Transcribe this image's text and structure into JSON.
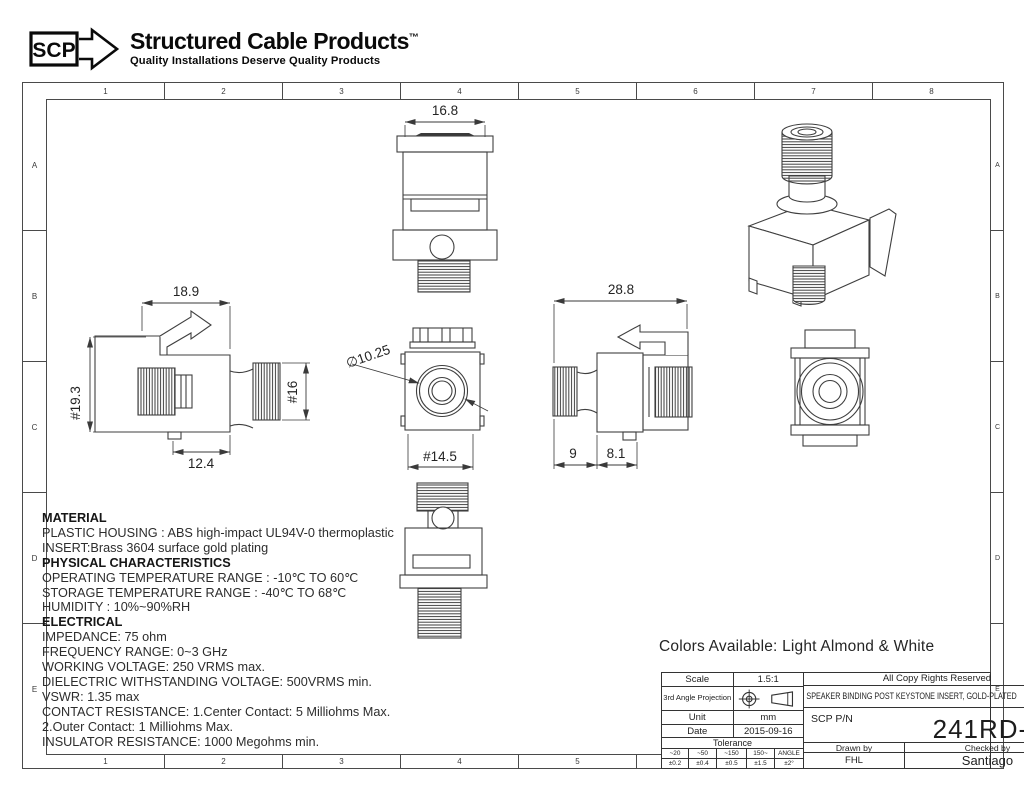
{
  "logo": {
    "abbr": "SCP",
    "name": "Structured Cable Products",
    "trademark": "™",
    "tagline": "Quality Installations Deserve Quality Products"
  },
  "grid": {
    "cols": [
      "1",
      "2",
      "3",
      "4",
      "5",
      "6",
      "7",
      "8"
    ],
    "rows": [
      "A",
      "B",
      "C",
      "D",
      "E"
    ]
  },
  "drawing": {
    "dims": {
      "top_width": "16.8",
      "side_width": "18.9",
      "side_height": "#19.3",
      "barrel_dia": "#16",
      "side_depth": "12.4",
      "bore_dia": "∅10.25",
      "face_width": "#14.5",
      "overall_depth": "28.8",
      "barrel_len": "9",
      "rear_len": "8.1"
    }
  },
  "specs": {
    "lines": [
      "MATERIAL",
      "PLASTIC HOUSING : ABS high-impact UL94V-0 thermoplastic",
      "INSERT:Brass 3604 surface gold plating",
      "PHYSICAL CHARACTERISTICS",
      "OPERATING TEMPERATURE RANGE : -10℃ TO 60℃",
      "STORAGE TEMPERATURE RANGE : -40℃ TO 68℃",
      "HUMIDITY : 10%~90%RH",
      "ELECTRICAL",
      "IMPEDANCE: 75 ohm",
      "FREQUENCY RANGE: 0~3 GHz",
      "WORKING VOLTAGE: 250 VRMS max.",
      "DIELECTRIC WITHSTANDING VOLTAGE: 500VRMS min.",
      "VSWR: 1.35 max",
      "CONTACT RESISTANCE: 1.Center Contact: 5 Milliohms Max.",
      "2.Outer Contact: 1 Milliohms Max.",
      "INSULATOR RESISTANCE: 1000 Megohms min."
    ]
  },
  "colors_note": "Colors Available: Light Almond & White",
  "title_block": {
    "scale_label": "Scale",
    "scale_value": "1.5:1",
    "copyright": "All Copy Rights Reserved",
    "projection_label": "3rd Angle Projection",
    "product_title": "SPEAKER BINDING POST KEYSTONE INSERT, GOLD-PLATED",
    "unit_label": "Unit",
    "unit_value": "mm",
    "date_label": "Date",
    "date_value": "2015-09-16",
    "pn_label": "SCP P/N",
    "pn_value": "241RD-XX",
    "tolerance_label": "Tolerance",
    "tolerance_cols": [
      {
        "range": "~20",
        "value": "±0.2"
      },
      {
        "range": "~50",
        "value": "±0.4"
      },
      {
        "range": "~150",
        "value": "±0.5"
      },
      {
        "range": "150~",
        "value": "±1.5"
      },
      {
        "range": "ANGLE",
        "value": "±2°"
      }
    ],
    "drawn_label": "Drawn by",
    "drawn_value": "FHL",
    "checked_label": "Checked by",
    "checked_value": "Santiago"
  }
}
